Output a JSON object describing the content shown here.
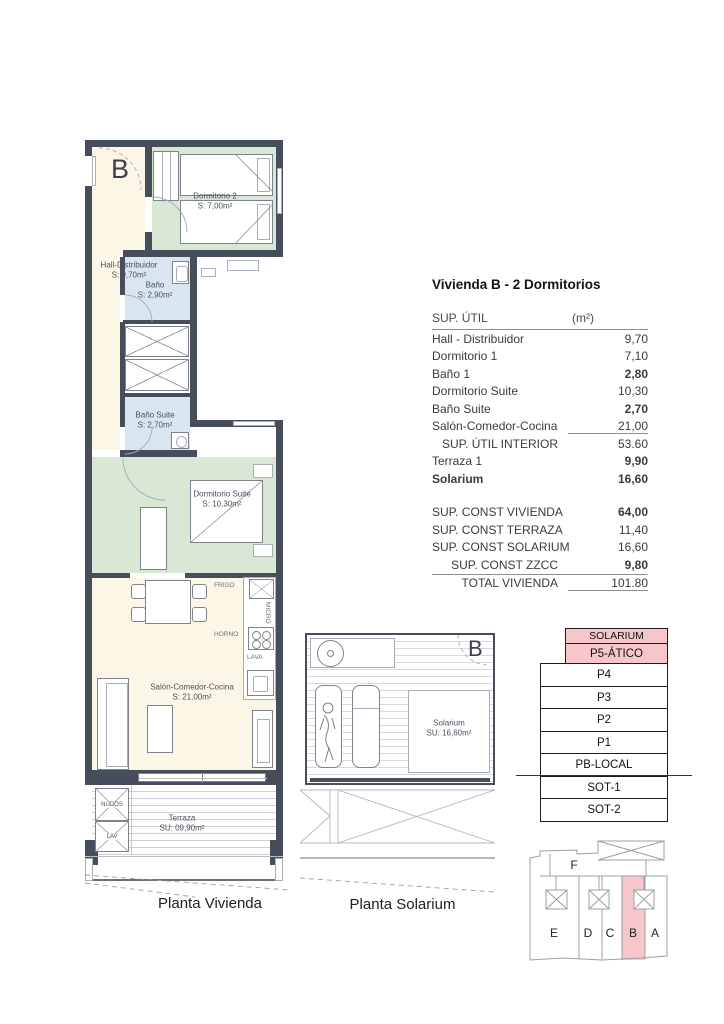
{
  "plan_vivienda": {
    "unit_label": "B",
    "caption": "Planta Vivienda",
    "rooms": {
      "hall": {
        "name": "Hall-Distribuidor",
        "area": "S: 9,70m²"
      },
      "dormitorio2": {
        "name": "Dormitorio 2",
        "area": "S: 7,00m²"
      },
      "bano": {
        "name": "Baño",
        "area": "S: 2,90m²"
      },
      "bano_suite": {
        "name": "Baño Suite",
        "area": "S: 2,70m²"
      },
      "dormitorio_suite": {
        "name": "Dormitorio Suite",
        "area": "S: 10,30m²"
      },
      "salon": {
        "name": "Salón-Comedor-Cocina",
        "area": "S: 21,00m²"
      },
      "terraza": {
        "name": "Terraza",
        "area": "SU: 09,90m²"
      }
    },
    "kitchen_labels": {
      "frigo": "FRIGO",
      "micro": "MICRO",
      "horno": "HORNO",
      "lava": "LAVA"
    },
    "terrace_boxes": {
      "nudos": "NUDOS",
      "lav": "LAV"
    }
  },
  "plan_solarium": {
    "unit_label": "B",
    "caption": "Planta Solarium",
    "room": {
      "name": "Solarium",
      "area": "SU: 16,60m²"
    }
  },
  "table": {
    "title": "Vivienda B - 2 Dormitorios",
    "header": {
      "label": "SUP. ÚTIL",
      "unit": "(m²)"
    },
    "rows": [
      {
        "label": "Hall - Distribuidor",
        "value": "9,70"
      },
      {
        "label": "Dormitorio 1",
        "value": "7,10"
      },
      {
        "label": "Baño 1",
        "value": "2,80"
      },
      {
        "label": "Dormitorio Suite",
        "value": "10,30"
      },
      {
        "label": "Baño Suite",
        "value": "2,70"
      },
      {
        "label": "Salón-Comedor-Cocina",
        "value": "21,00"
      },
      {
        "label": "SUP. ÚTIL INTERIOR",
        "value": "53.60"
      },
      {
        "label": "Terraza 1",
        "value": "9,90"
      },
      {
        "label": "Solarium",
        "value": "16,60"
      }
    ],
    "summary": [
      {
        "label": "SUP. CONST VIVIENDA",
        "value": "64,00"
      },
      {
        "label": "SUP. CONST TERRAZA",
        "value": "11,40"
      },
      {
        "label": "SUP. CONST SOLARIUM",
        "value": "16,60"
      },
      {
        "label": "SUP. CONST ZZCC",
        "value": "9,80"
      },
      {
        "label": "TOTAL VIVIENDA",
        "value": "101.80"
      }
    ]
  },
  "levels": [
    "SOLARIUM",
    "P5-ÁTICO",
    "P4",
    "P3",
    "P2",
    "P1",
    "PB-LOCAL",
    "SOT-1",
    "SOT-2"
  ],
  "site_plan": {
    "top_block": "F",
    "blocks": [
      "E",
      "D",
      "C",
      "B",
      "A"
    ],
    "highlighted_block": "B"
  },
  "colors": {
    "wall": "#474e5b",
    "room_cream": "#fcf6e7",
    "room_green": "#d8e8d4",
    "room_blue": "#d9e6f1",
    "highlight_pink": "#f7c6cb"
  }
}
